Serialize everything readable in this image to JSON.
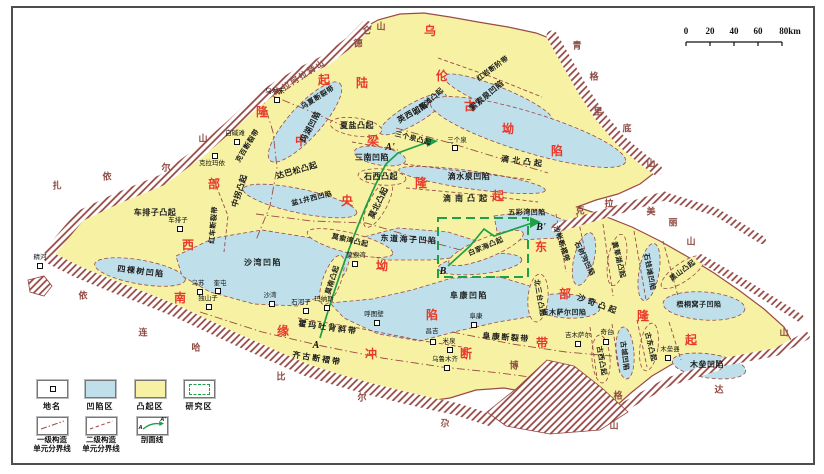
{
  "colors": {
    "uplift_area": "#f7f2a3",
    "depression_area": "#bfe0ea",
    "mountain_hatch": "#93423e",
    "major_unit_text": "#e8392c",
    "section_line_green": "#1fa048",
    "boundary_line": "#9b4a44"
  },
  "scalebar": {
    "ticks": [
      "0",
      "20",
      "40",
      "60",
      "80km"
    ]
  },
  "legend": {
    "row1": [
      {
        "label": "地名"
      },
      {
        "label": "凹陷区"
      },
      {
        "label": "凸起区"
      },
      {
        "label": "研究区"
      }
    ],
    "row2": [
      {
        "line1": "一级构造",
        "line2": "单元分界线"
      },
      {
        "line1": "二级构造",
        "line2": "单元分界线"
      },
      {
        "line1": "剖面线",
        "line2": ""
      }
    ],
    "section_a": "A",
    "section_a_prime": "A'"
  },
  "map": {
    "major_units": [
      {
        "name": "西部隆起",
        "chars": [
          {
            "ch": "西",
            "x": 188,
            "y": 245
          },
          {
            "ch": "部",
            "x": 214,
            "y": 184
          },
          {
            "ch": "隆",
            "x": 262,
            "y": 112
          },
          {
            "ch": "起",
            "x": 324,
            "y": 80
          }
        ]
      },
      {
        "name": "乌伦古坳陷",
        "chars": [
          {
            "ch": "乌",
            "x": 430,
            "y": 31
          },
          {
            "ch": "伦",
            "x": 442,
            "y": 76
          },
          {
            "ch": "古",
            "x": 470,
            "y": 106
          },
          {
            "ch": "坳",
            "x": 508,
            "y": 129
          },
          {
            "ch": "陷",
            "x": 557,
            "y": 151
          }
        ]
      },
      {
        "name": "陆梁隆起",
        "chars": [
          {
            "ch": "陆",
            "x": 362,
            "y": 83
          },
          {
            "ch": "梁",
            "x": 373,
            "y": 141
          },
          {
            "ch": "隆",
            "x": 421,
            "y": 183
          },
          {
            "ch": "起",
            "x": 498,
            "y": 196
          }
        ]
      },
      {
        "name": "中央坳陷",
        "chars": [
          {
            "ch": "中",
            "x": 301,
            "y": 141
          },
          {
            "ch": "央",
            "x": 347,
            "y": 201
          },
          {
            "ch": "坳",
            "x": 382,
            "y": 266
          },
          {
            "ch": "陷",
            "x": 432,
            "y": 315
          }
        ]
      },
      {
        "name": "东部隆起",
        "chars": [
          {
            "ch": "东",
            "x": 541,
            "y": 247
          },
          {
            "ch": "部",
            "x": 565,
            "y": 294
          },
          {
            "ch": "隆",
            "x": 643,
            "y": 316
          },
          {
            "ch": "起",
            "x": 691,
            "y": 340
          }
        ]
      },
      {
        "name": "南缘冲断带",
        "chars": [
          {
            "ch": "南",
            "x": 180,
            "y": 298
          },
          {
            "ch": "缘",
            "x": 283,
            "y": 331
          },
          {
            "ch": "冲",
            "x": 371,
            "y": 354
          },
          {
            "ch": "断",
            "x": 466,
            "y": 354
          },
          {
            "ch": "带",
            "x": 542,
            "y": 343
          }
        ]
      }
    ],
    "unit_labels": [
      {
        "t": "车排子凸起",
        "x": 155,
        "y": 213,
        "r": 0
      },
      {
        "t": "中拐凸起",
        "x": 240,
        "y": 191,
        "r": -72
      },
      {
        "t": "红车断裂带",
        "x": 214,
        "y": 225,
        "r": -85,
        "fs": 7
      },
      {
        "t": "克百断裂带",
        "x": 248,
        "y": 146,
        "r": -58,
        "fs": 7
      },
      {
        "t": "乌夏断裂带",
        "x": 318,
        "y": 98,
        "r": -32,
        "fs": 7
      },
      {
        "t": "达巴松凸起",
        "x": 297,
        "y": 171,
        "r": -16
      },
      {
        "t": "玛湖凹陷",
        "x": 311,
        "y": 127,
        "r": -62
      },
      {
        "t": "英西凹陷",
        "x": 413,
        "y": 113,
        "r": -30
      },
      {
        "t": "石英滩凸起",
        "x": 429,
        "y": 102,
        "r": -42,
        "fs": 7
      },
      {
        "t": "索索泉凹陷",
        "x": 487,
        "y": 96,
        "r": -40
      },
      {
        "t": "红岩断阶带",
        "x": 493,
        "y": 69,
        "r": -36,
        "fs": 7
      },
      {
        "t": "三个泉凸起",
        "x": 413,
        "y": 139,
        "r": 14,
        "fs": 7
      },
      {
        "t": "三南凹陷",
        "x": 372,
        "y": 158,
        "r": 0
      },
      {
        "t": "夏盐凸起",
        "x": 357,
        "y": 126,
        "r": 0
      },
      {
        "t": "石西凸起",
        "x": 381,
        "y": 177,
        "r": 0
      },
      {
        "t": "滴北凸起",
        "x": 523,
        "y": 162,
        "r": 7,
        "ls": 3
      },
      {
        "t": "滴水泉凹陷",
        "x": 469,
        "y": 177,
        "r": 0
      },
      {
        "t": "滴南凸起",
        "x": 467,
        "y": 199,
        "r": 0,
        "ls": 4
      },
      {
        "t": "五彩湾凹陷",
        "x": 527,
        "y": 213,
        "r": 0,
        "fs": 7
      },
      {
        "t": "盆1井西凹陷",
        "x": 312,
        "y": 199,
        "r": -14,
        "fs": 7
      },
      {
        "t": "莫北凸起",
        "x": 379,
        "y": 203,
        "r": -64
      },
      {
        "t": "莫索湾凸起",
        "x": 350,
        "y": 241,
        "r": 13,
        "fs": 7
      },
      {
        "t": "莫南凸起",
        "x": 333,
        "y": 280,
        "r": -72,
        "fs": 7
      },
      {
        "t": "东道海子凹陷",
        "x": 409,
        "y": 240,
        "r": 3,
        "ls": 1.5
      },
      {
        "t": "白家海凸起",
        "x": 486,
        "y": 247,
        "r": -23,
        "fs": 7
      },
      {
        "t": "四棵树凹陷",
        "x": 141,
        "y": 272,
        "r": 7,
        "ls": 1.5
      },
      {
        "t": "沙湾凹陷",
        "x": 263,
        "y": 263,
        "r": 0,
        "ls": 1.5
      },
      {
        "t": "霍玛吐背斜带",
        "x": 328,
        "y": 328,
        "r": 8,
        "ls": 2
      },
      {
        "t": "齐古断褶带",
        "x": 317,
        "y": 359,
        "r": 9,
        "ls": 2
      },
      {
        "t": "阜康凹陷",
        "x": 469,
        "y": 296,
        "r": 0,
        "ls": 1.5
      },
      {
        "t": "阜康断裂带",
        "x": 506,
        "y": 338,
        "r": 4,
        "ls": 1.5
      },
      {
        "t": "吉木萨尔凹陷",
        "x": 564,
        "y": 313,
        "r": 0,
        "fs": 7
      },
      {
        "t": "北三台凸起",
        "x": 539,
        "y": 298,
        "r": 80,
        "fs": 7
      },
      {
        "t": "沙帐断褶带",
        "x": 561,
        "y": 244,
        "r": 72,
        "fs": 7
      },
      {
        "t": "石树沟凹陷",
        "x": 584,
        "y": 259,
        "r": 64,
        "fs": 7
      },
      {
        "t": "黄草湖凸起",
        "x": 618,
        "y": 260,
        "r": 76,
        "fs": 7
      },
      {
        "t": "石钱滩凹陷",
        "x": 649,
        "y": 272,
        "r": 79,
        "fs": 7
      },
      {
        "t": "黑山凸起",
        "x": 683,
        "y": 271,
        "r": -37,
        "fs": 7
      },
      {
        "t": "梧桐窝子凹陷",
        "x": 699,
        "y": 305,
        "r": 0,
        "fs": 7
      },
      {
        "t": "沙奇凸起",
        "x": 598,
        "y": 305,
        "r": 20,
        "ls": 3
      },
      {
        "t": "古西凸起",
        "x": 601,
        "y": 361,
        "r": 80,
        "fs": 7
      },
      {
        "t": "古城凹陷",
        "x": 624,
        "y": 356,
        "r": 83,
        "fs": 7
      },
      {
        "t": "古东凸起",
        "x": 650,
        "y": 347,
        "r": 77,
        "fs": 7
      },
      {
        "t": "木垒凹陷",
        "x": 707,
        "y": 365,
        "r": 0
      }
    ],
    "mountain_labels": [
      {
        "t": "哈拉阿拉特山",
        "x": 300,
        "y": 78,
        "r": -33
      },
      {
        "name": "扎依尔山",
        "chars": [
          {
            "ch": "扎",
            "x": 57,
            "y": 186
          },
          {
            "ch": "依",
            "x": 107,
            "y": 177
          },
          {
            "ch": "尔",
            "x": 166,
            "y": 168
          },
          {
            "ch": "山",
            "x": 203,
            "y": 139
          }
        ]
      },
      {
        "name": "德仑山",
        "chars": [
          {
            "ch": "德",
            "x": 358,
            "y": 44
          },
          {
            "ch": "仑",
            "x": 367,
            "y": 31
          },
          {
            "ch": "山",
            "x": 381,
            "y": 27
          }
        ]
      },
      {
        "name": "青格里底山",
        "chars": [
          {
            "ch": "青",
            "x": 577,
            "y": 46
          },
          {
            "ch": "格",
            "x": 594,
            "y": 77
          },
          {
            "ch": "里",
            "x": 598,
            "y": 112
          },
          {
            "ch": "底",
            "x": 627,
            "y": 129
          },
          {
            "ch": "山",
            "x": 651,
            "y": 164
          }
        ]
      },
      {
        "name": "克拉美丽山",
        "chars": [
          {
            "ch": "克",
            "x": 580,
            "y": 211
          },
          {
            "ch": "拉",
            "x": 609,
            "y": 204
          },
          {
            "ch": "美",
            "x": 651,
            "y": 212
          },
          {
            "ch": "丽",
            "x": 673,
            "y": 223
          },
          {
            "ch": "山",
            "x": 691,
            "y": 242
          }
        ]
      },
      {
        "name": "博格达山",
        "chars": [
          {
            "ch": "博",
            "x": 514,
            "y": 366
          },
          {
            "ch": "格",
            "x": 618,
            "y": 396
          },
          {
            "ch": "达",
            "x": 719,
            "y": 390
          },
          {
            "ch": "山",
            "x": 784,
            "y": 333
          }
        ]
      },
      {
        "name": "依连哈比尔尕山",
        "chars": [
          {
            "ch": "依",
            "x": 83,
            "y": 296
          },
          {
            "ch": "连",
            "x": 143,
            "y": 333
          },
          {
            "ch": "哈",
            "x": 196,
            "y": 348
          },
          {
            "ch": "比",
            "x": 281,
            "y": 377
          },
          {
            "ch": "尔",
            "x": 362,
            "y": 398
          },
          {
            "ch": "尕",
            "x": 445,
            "y": 424
          },
          {
            "ch": "山",
            "x": 614,
            "y": 426
          }
        ]
      }
    ],
    "towns": [
      {
        "n": "乌尔禾",
        "lx": 275,
        "ly": 92,
        "bx": 277,
        "by": 100
      },
      {
        "n": "白碱滩",
        "lx": 235,
        "ly": 134,
        "bx": 237,
        "by": 142
      },
      {
        "n": "克拉玛依",
        "lx": 212,
        "ly": 164,
        "bx": 215,
        "by": 156
      },
      {
        "n": "车排子",
        "lx": 178,
        "ly": 221,
        "bx": 180,
        "by": 229
      },
      {
        "n": "精河",
        "lx": 40,
        "ly": 258,
        "bx": 40,
        "by": 266
      },
      {
        "n": "乌苏",
        "lx": 198,
        "ly": 284,
        "bx": 200,
        "by": 292
      },
      {
        "n": "奎屯",
        "lx": 220,
        "ly": 284,
        "bx": 218,
        "by": 291
      },
      {
        "n": "独山子",
        "lx": 208,
        "ly": 299,
        "bx": 209,
        "by": 307
      },
      {
        "n": "沙湾",
        "lx": 270,
        "ly": 296,
        "bx": 272,
        "by": 304
      },
      {
        "n": "石河子",
        "lx": 301,
        "ly": 303,
        "bx": 306,
        "by": 311
      },
      {
        "n": "玛纳斯",
        "lx": 324,
        "ly": 300,
        "bx": 327,
        "by": 308
      },
      {
        "n": "呼图壁",
        "lx": 374,
        "ly": 315,
        "bx": 377,
        "by": 323
      },
      {
        "n": "昌吉",
        "lx": 432,
        "ly": 332,
        "bx": 433,
        "by": 342
      },
      {
        "n": "米泉",
        "lx": 449,
        "ly": 342,
        "bx": 450,
        "by": 350
      },
      {
        "n": "乌鲁木齐",
        "lx": 445,
        "ly": 360,
        "bx": 447,
        "by": 368
      },
      {
        "n": "阜康",
        "lx": 476,
        "ly": 317,
        "bx": 474,
        "by": 325
      },
      {
        "n": "吉木萨尔",
        "lx": 578,
        "ly": 336,
        "bx": 578,
        "by": 344
      },
      {
        "n": "奇台",
        "lx": 607,
        "ly": 333,
        "bx": 606,
        "by": 342
      },
      {
        "n": "木垒县",
        "lx": 670,
        "ly": 350,
        "bx": 668,
        "by": 358
      },
      {
        "n": "三个泉",
        "lx": 457,
        "ly": 141,
        "bx": 455,
        "by": 148
      },
      {
        "n": "莫索湾",
        "lx": 356,
        "ly": 256,
        "bx": 355,
        "by": 264
      }
    ],
    "section_labels": [
      {
        "t": "A",
        "x": 316,
        "y": 346
      },
      {
        "t": "A'",
        "x": 390,
        "y": 148
      },
      {
        "t": "B",
        "x": 443,
        "y": 272
      },
      {
        "t": "B'",
        "x": 541,
        "y": 228
      }
    ]
  }
}
